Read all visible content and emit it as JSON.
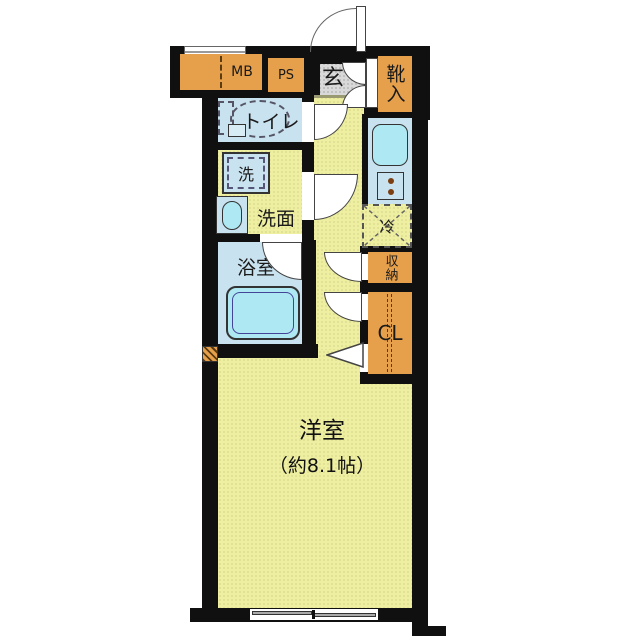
{
  "plan_title": "1K floor plan",
  "labels": {
    "mb": "MB",
    "ps": "PS",
    "entrance": "玄",
    "shoe_cabinet": "靴入",
    "toilet": "トイレ",
    "washer": "洗",
    "washroom": "洗面",
    "bathroom": "浴室",
    "refrigerator": "冷",
    "storage": "収納",
    "closet": "CL",
    "room": "洋室",
    "room_size": "（約8.1帖）"
  },
  "colors": {
    "floor_yellow": "#EFEFA2",
    "wet_room_blue": "#C9E2EF",
    "fixture_cyan": "#AEE8F2",
    "cabinet_orange": "#E6A04C",
    "entrance_gray": "#D9D9D9",
    "wall_black": "#101010"
  }
}
